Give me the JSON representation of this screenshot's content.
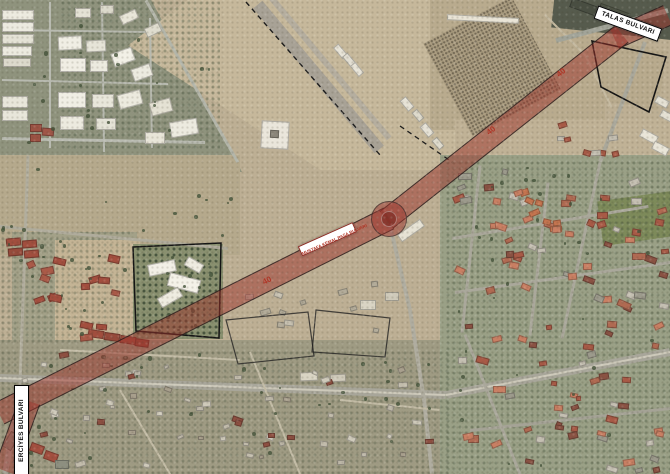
{
  "map": {
    "road_labels": {
      "talas": "TALAS BULVARI",
      "central": "MUSTAFA KEMAL PAŞA BULVARI",
      "erciyes": "ERCİYES BULVARI"
    },
    "width_markers": [
      "40",
      "40",
      "40"
    ],
    "legend_colors": {
      "highlighted_road": "#9e342c",
      "road_width_text": "#b03526",
      "label_background": "#ffffff",
      "label_text": "#111111"
    }
  }
}
